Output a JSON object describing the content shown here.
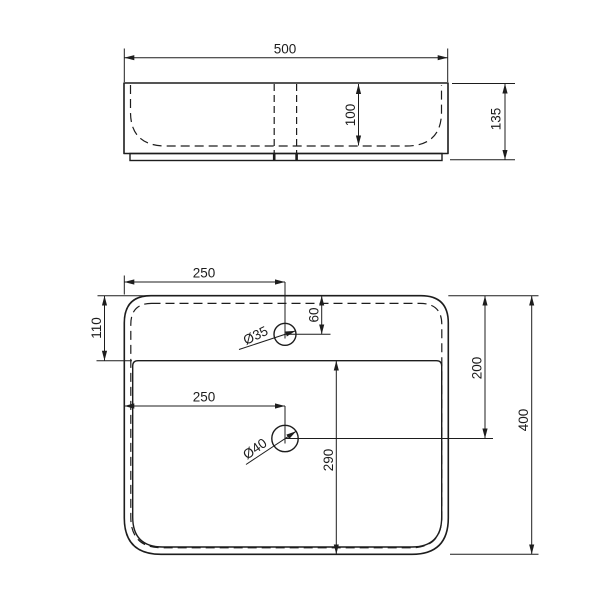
{
  "drawing": {
    "background": "#ffffff",
    "line_color": "#1d1d1d",
    "views": {
      "elevation": {
        "dim_width": "500",
        "dim_bowl_depth": "100",
        "dim_height": "135"
      },
      "plan": {
        "dim_faucet_from_left": "250",
        "dim_ledge_from_back": "110",
        "dim_faucet_from_back": "60",
        "dim_drain_from_back": "200",
        "dim_depth": "400",
        "dim_drain_from_left": "250",
        "dim_bowl_front": "290",
        "faucet_hole_dia": "Ø35",
        "drain_hole_dia": "Ø40"
      }
    }
  }
}
